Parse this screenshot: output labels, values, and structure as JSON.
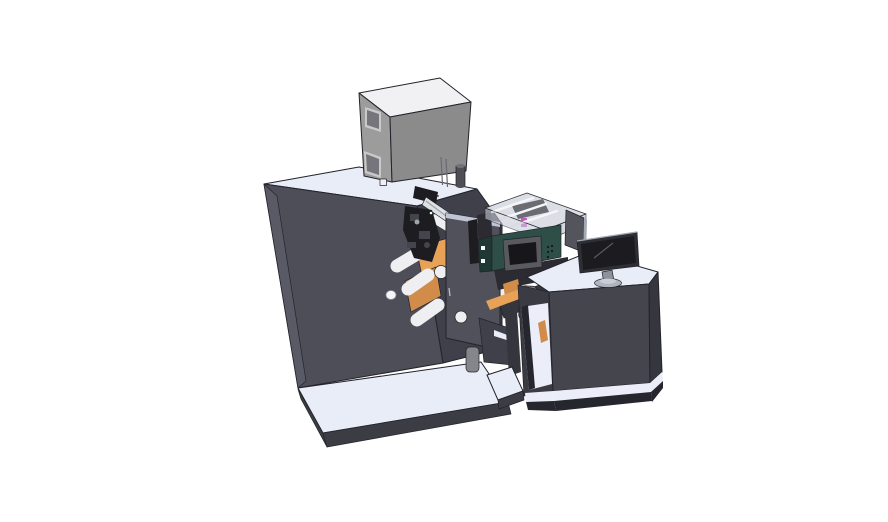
{
  "meta": {
    "description": "3D CAD isometric render of a label printing machine line: main cabinet with electrical box on top, unwind rollers with orange web, print engine with transparent cover, conveyor bridge and operator desk with monitor",
    "background": "#ffffff"
  },
  "parts": [
    "main-cabinet",
    "electrical-box",
    "exhaust-cylinder",
    "machine-platform",
    "unwind-rollers",
    "web-material",
    "print-mechanism",
    "guide-rail",
    "rewind-tower",
    "print-engine",
    "transparent-cover",
    "engine-control-panel",
    "conveyor-bridge",
    "sensor-bracket",
    "operator-desk",
    "desk-shelf",
    "desk-monitor",
    "rear-display-panel",
    "monitor-stand"
  ],
  "colors": {
    "background": "#ffffff",
    "outline": "#23232a",
    "surface_top": "#e9edf8",
    "cabinet_front": "#4e4e59",
    "cabinet_side": "#5a5a66",
    "cabinet_recess": "#40404b",
    "platform_side": "#3c3c45",
    "box_top": "#f1f1f3",
    "box_front": "#8b8b8b",
    "box_side": "#9c9c9c",
    "box_window": "#75757b",
    "box_window_frame": "#c9c9c9",
    "box_vent": "#6b6b70",
    "cylinder": "#4e4e54",
    "cylinder_top": "#71717a",
    "orange_web": "#e7a258",
    "orange_web_dark": "#d18c4a",
    "roller": "#efeff2",
    "roller_edge": "#c0c0c8",
    "mech_dark": "#1c1c21",
    "mech_mid": "#44444c",
    "rail_silver": "#dde0e5",
    "rail_shade": "#9fa3aa",
    "tower_face": "#51515b",
    "tower_top": "#bfc5d2",
    "frame_dark": "#2b2b31",
    "conveyor_dark": "#35353e",
    "teal_body": "#2e4f48",
    "teal_end": "#1f3833",
    "panel_frame": "#595960",
    "screen_dark": "#17171b",
    "cover_top": "#d9dde4",
    "cover_side": "#c7ccd6",
    "cover_strut": "#f5f6f8",
    "magenta_part": "#c557c0",
    "bracket_gray": "#85858c",
    "desk_front": "#45454e",
    "desk_side": "#36363f",
    "desk_left": "#3b3b44",
    "desk_base": "#26262e",
    "shelf_white": "#ebeef8",
    "monitor_bezel": "#2e2e35",
    "monitor_screen": "#1b1b20",
    "monitor_stand": "#8d919b",
    "monitor_base": "#b0b4be",
    "monitor_base_top": "#c9cdd6",
    "panel_back": "#54545d",
    "panel_edge_light": "#a4a8b2",
    "reflection": "#5a5a66",
    "handle_white": "#f5f6fa",
    "detail_gray": "#62626c"
  }
}
